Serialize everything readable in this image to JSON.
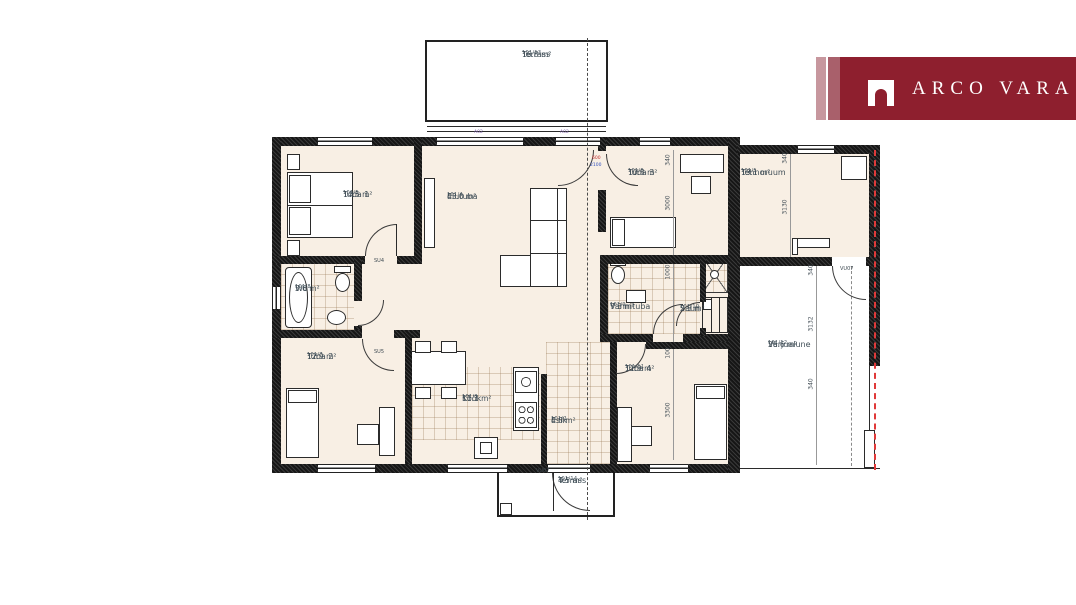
{
  "brand": {
    "name": "ARCO VARA"
  },
  "colors": {
    "logo_main": "#8e1f2e",
    "logo_stripe_light": "#c7979e",
    "logo_stripe_mid": "#a9606b",
    "floor": "#f8efe4",
    "wall": "#161616",
    "boundary_red": "#e03a3a",
    "label_text": "#414f58"
  },
  "rooms": [
    {
      "id": "terrass-top",
      "code": "101/13",
      "name": "Terrass",
      "area": "16.8 m²"
    },
    {
      "id": "tuba1",
      "code": "101/5",
      "name": "Tuba 1",
      "area": "14.5 m²"
    },
    {
      "id": "elutuba",
      "code": "101/4",
      "name": "Elutuba",
      "area": "43.0 m²"
    },
    {
      "id": "tuba3",
      "code": "101/6",
      "name": "Tuba 3",
      "area": "10.8 m²"
    },
    {
      "id": "tehnoruum",
      "code": "101/1",
      "name": "Tehnoruum",
      "area": "13.1 m²"
    },
    {
      "id": "wc",
      "code": "101/8",
      "name": "Wc",
      "area": "3.6 m²"
    },
    {
      "id": "tuba2",
      "code": "101/7",
      "name": "Tuba 2",
      "area": "12.9 m²"
    },
    {
      "id": "kook",
      "code": "101/3",
      "name": "Köök",
      "area": "11.1 m²"
    },
    {
      "id": "esik",
      "code": "101/2",
      "name": "Esik",
      "area": "4.8 m²"
    },
    {
      "id": "vannituba",
      "code": "101/9",
      "name": "Vannituba",
      "area": "7.3 m²"
    },
    {
      "id": "saun",
      "code": "101/10",
      "name": "Saun",
      "area": "2.3 m²"
    },
    {
      "id": "tuba4",
      "code": "101/11",
      "name": "Tuba 4",
      "area": "11.9 m²"
    },
    {
      "id": "varjualune",
      "code": "101/12",
      "name": "Varjualune",
      "area": "26.6 m²"
    },
    {
      "id": "terrass-bottom",
      "code": "101/14",
      "name": "Terrass",
      "area": "4.5 m²"
    }
  ],
  "dimensions": {
    "tuba3_offset": "340",
    "tuba3_height": "3000",
    "shower": "1000",
    "tuba4_offset": "100",
    "tuba4_height": "3300",
    "tehno_offset": "340",
    "tehno_height": "3130",
    "varju_offset_top": "340",
    "varju_height": "3132",
    "varju_offset_bottom": "340"
  },
  "openings": {
    "su4": "SU4",
    "su5": "SU5",
    "vu07": "VU07",
    "window_a02": "A02",
    "door_w": "600",
    "door_h": "2100"
  }
}
